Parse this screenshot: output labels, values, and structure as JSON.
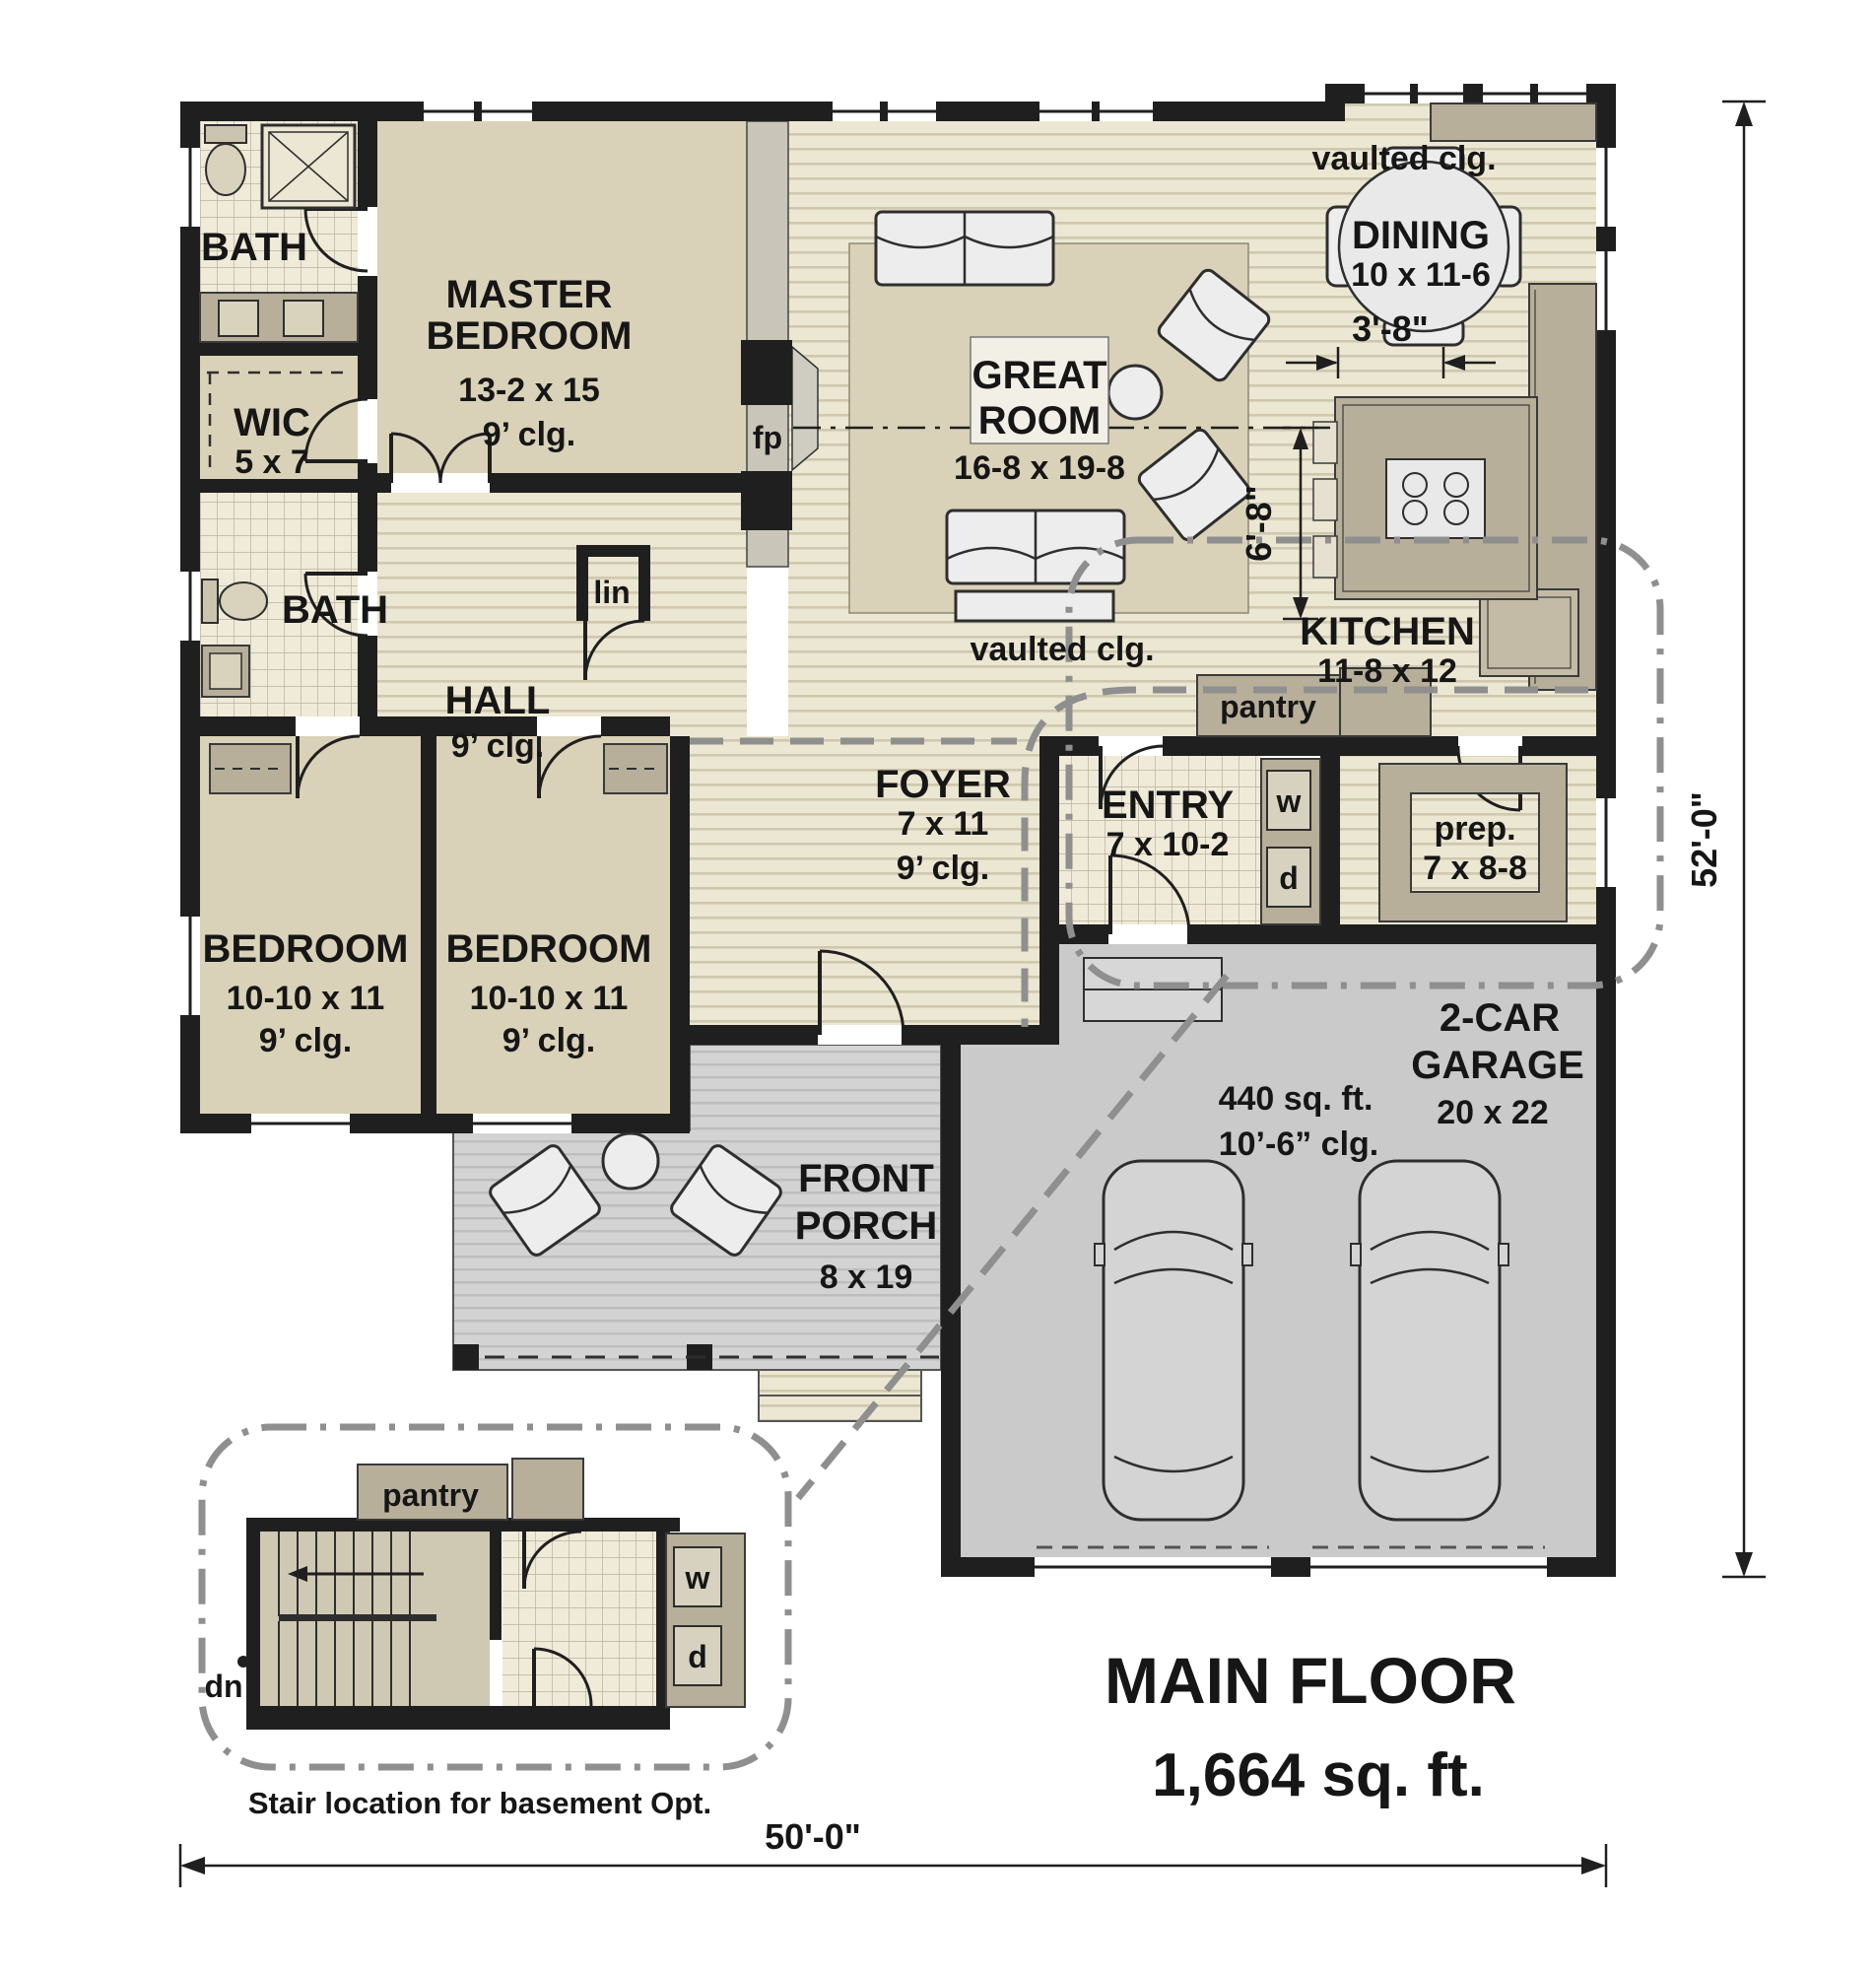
{
  "plan": {
    "colors": {
      "wall": "#1f1f1f",
      "room_beige": "#d9d2b8",
      "cabinet_tan": "#b8af9a",
      "floor_stripe": "#cfc8af",
      "porch_gray": "#d3d3d3",
      "garage_gray": "#cacaca",
      "dash_gray": "#8f8f8f"
    },
    "title": {
      "line1": "MAIN FLOOR",
      "line2": "1,664 sq. ft."
    },
    "rooms": {
      "bath1": {
        "name": "BATH"
      },
      "master": {
        "name1": "MASTER",
        "name2": "BEDROOM",
        "size": "13-2 x 15",
        "ceiling": "9’ clg."
      },
      "wic": {
        "name": "WIC",
        "size": "5 x 7"
      },
      "bath2": {
        "name": "BATH"
      },
      "hall": {
        "name": "HALL",
        "ceiling": "9’ clg."
      },
      "linen": {
        "name": "lin"
      },
      "fireplace": {
        "name": "fp"
      },
      "great_room": {
        "name1": "GREAT",
        "name2": "ROOM",
        "size": "16-8 x 19-8"
      },
      "dining": {
        "name": "DINING",
        "size": "10 x 11-6"
      },
      "kitchen": {
        "name": "KITCHEN",
        "size": "11-8 x 12"
      },
      "pantry": {
        "name": "pantry"
      },
      "entry": {
        "name": "ENTRY",
        "size": "7 x 10-2",
        "washer": "w",
        "dryer": "d"
      },
      "prep": {
        "name": "prep.",
        "size": "7 x 8-8"
      },
      "foyer": {
        "name": "FOYER",
        "size": "7 x 11",
        "ceiling": "9’ clg."
      },
      "bedroom2": {
        "name": "BEDROOM",
        "size": "10-10 x 11",
        "ceiling": "9’ clg."
      },
      "bedroom3": {
        "name": "BEDROOM",
        "size": "10-10 x 11",
        "ceiling": "9’ clg."
      },
      "porch": {
        "name1": "FRONT",
        "name2": "PORCH",
        "size": "8 x 19"
      },
      "garage": {
        "name1": "2-CAR",
        "name2": "GARAGE",
        "size": "20 x 22",
        "area": "440 sq. ft.",
        "ceiling": "10’-6” clg."
      }
    },
    "notes": {
      "vaulted_top": "vaulted clg.",
      "vaulted_center": "vaulted clg."
    },
    "dimensions": {
      "dining_offset": "3'-8\"",
      "ridge_offset": "6'-8\"",
      "height": "52'-0\"",
      "width": "50'-0\""
    },
    "inset": {
      "pantry": "pantry",
      "down": "dn",
      "washer": "w",
      "dryer": "d",
      "caption": "Stair location for basement Opt."
    }
  }
}
